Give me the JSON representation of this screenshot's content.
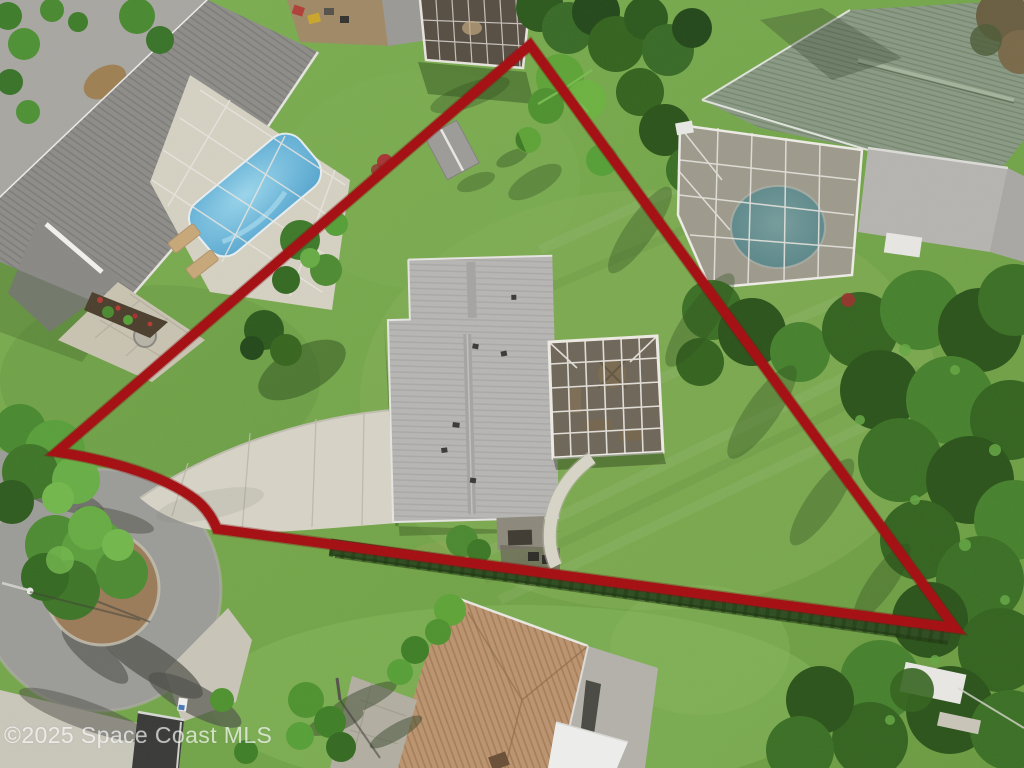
{
  "image": {
    "kind": "aerial-drone-photograph",
    "subject": "single-family home lot outlined with red property boundary",
    "width_px": 1024,
    "height_px": 768
  },
  "watermark": {
    "text": "©2025 Space Coast MLS",
    "color": "#ffffff",
    "opacity": 0.82
  },
  "boundary": {
    "color": "#a50e12",
    "stroke_width": 9.5,
    "shape": "triangular lot outline",
    "vertices_px": [
      [
        530,
        45
      ],
      [
        57,
        452
      ],
      [
        218,
        530
      ],
      [
        955,
        628
      ]
    ]
  },
  "palette": {
    "grass": "#79a94e",
    "grass_shade": "#2e4d1e",
    "road_asphalt": "#9c9c98",
    "concrete_driveway": "#d7d4c7",
    "subject_roof_gray": "#b7b6b4",
    "left_neighbor_roof": "#8e8d89",
    "right_neighbor_roof": "#8a9a85",
    "bottom_house_roof": "#bb9470",
    "pool_blue": "#64b2d8",
    "pool_teal": "#55a0ac",
    "lanai_screen": "#3f382e",
    "screen_frame_white": "#e8e5df",
    "hedge_dark_green": "#2e4d20",
    "mulch_brown": "#9b7c5a"
  },
  "scene": {
    "subject_house": "gray shingle roof, two offset sections with screened lanai on east side",
    "lanai": "white aluminum screen enclosure with patio furniture",
    "walkway": "curved concrete path from lanai to south hedge",
    "driveway": "concrete drive from cul-de-sac to house",
    "cul_de_sac": "asphalt bulb with palm-planted mulch island and street light",
    "left_neighbor": "dark gray roof home with screened kidney-shaped blue pool and lounge chairs",
    "right_neighbor": "green shingle roof home with screened round teal pool",
    "bottom_house": "tan shingle roof home with gray and white roof sections",
    "hedge": "dark hedge row along south boundary line",
    "forest": "dense tree canopy along east side",
    "small_structures": "backyard shed, white shed in trees, mailbox, trash pad"
  }
}
